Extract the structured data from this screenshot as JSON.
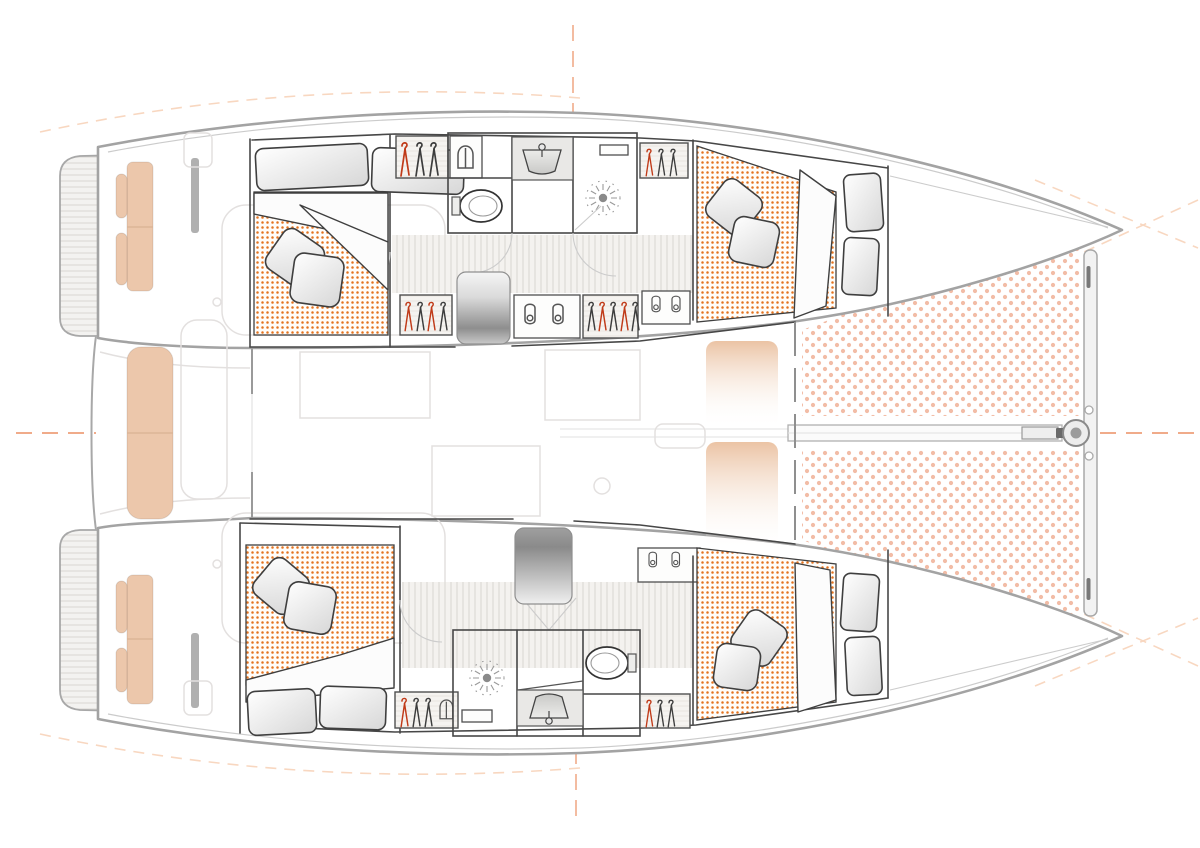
{
  "page": {
    "title": "Catamaran interior deck plan (overhead view, bow to the right)"
  },
  "diagram": {
    "type": "floorplan",
    "vessel": "sailing catamaran",
    "view": "overhead deck plan",
    "orientation_bow": "right",
    "hulls": 2,
    "cabins": [
      {
        "id": "aft-port",
        "bed": "double",
        "mattress_pattern": "orange-dots",
        "pillows": 4
      },
      {
        "id": "forward-port",
        "bed": "double",
        "mattress_pattern": "orange-dots",
        "pillows": 4
      },
      {
        "id": "aft-starboard",
        "bed": "double",
        "mattress_pattern": "orange-dots",
        "pillows": 4
      },
      {
        "id": "forward-starboard",
        "bed": "double",
        "mattress_pattern": "orange-dots",
        "pillows": 4
      }
    ],
    "bathrooms": [
      {
        "id": "port-head",
        "fixtures": [
          "toilet",
          "sink",
          "shower-drain"
        ]
      },
      {
        "id": "starboard-head",
        "fixtures": [
          "shower-drain",
          "sink",
          "toilet"
        ]
      }
    ],
    "wardrobes_with_hangers": 6,
    "shoe_lockers": 3,
    "companionway_stairs": 2,
    "cockpit": {
      "benches": 3,
      "helm_seat_pads": 4,
      "swim_platforms": 2,
      "table_outline": 1
    },
    "foredeck": {
      "trampoline_panels": 2,
      "crossbeam": true,
      "bowsprit_beam": true,
      "furler_fitting": true
    }
  },
  "colors": {
    "background": "#ffffff",
    "hull_outline": "#a3a3a3",
    "sheer_line": "#cbcbcb",
    "wall": "#474747",
    "furniture_line": "#3f3f3f",
    "mattress_dot": "#e4731f",
    "mattress_bg": "#fffdfa",
    "trampoline_dot": "#f2bca6",
    "teak_stripe": "#dcd9d5",
    "deck_bg": "#f3f2f0",
    "plank_stripe": "#dcd8d3",
    "wood_grain": "#e9e5df",
    "wood_bg": "#f5f3f0",
    "seat_tan": "#ecc7ab",
    "pad_tan": "#ebc3a4",
    "steps_dark": "#8e8e8e",
    "steps_light": "#f2f2f2",
    "hanger_dark": "#3d3d3d",
    "hanger_red": "#c03a18",
    "centerline": "#f0ab8a",
    "guide_dash": "#f6c9ab",
    "ghost_line": "#e3e0df",
    "metal": "#8a8a8a",
    "fixture_line": "#555555"
  },
  "icons": [
    "toilet-icon",
    "sink-icon",
    "shower-drain-icon",
    "clothes-hanger-icon",
    "shoe-icon",
    "locker-icon",
    "staircase-icon",
    "pillow-shape",
    "duvet-shape",
    "trampoline-dots-pattern",
    "mattress-dots-pattern",
    "teak-deck-stripes",
    "centerline-dashes"
  ]
}
